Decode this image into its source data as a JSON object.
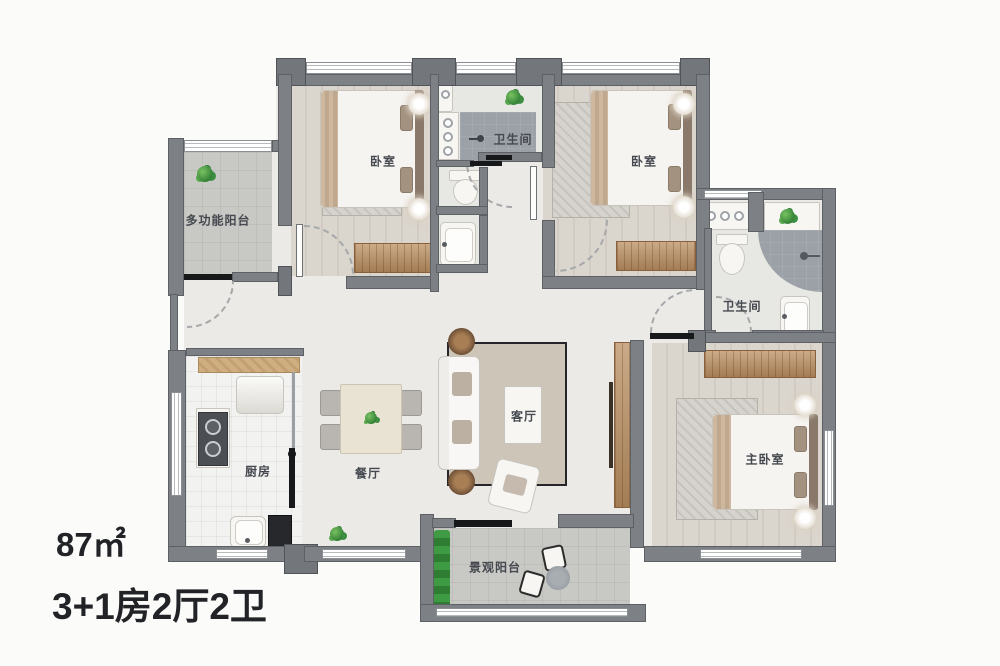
{
  "annotation": {
    "area": "87㎡",
    "layout": "3+1房2厅2卫"
  },
  "rooms": {
    "multi_balcony": {
      "label": "多功能阳台"
    },
    "bedroom1": {
      "label": "卧室"
    },
    "bath_top": {
      "label": "卫生间"
    },
    "bedroom2": {
      "label": "卧室"
    },
    "bath_right": {
      "label": "卫生间"
    },
    "kitchen": {
      "label": "厨房"
    },
    "dining": {
      "label": "餐厅"
    },
    "living": {
      "label": "客厅"
    },
    "master_bedroom": {
      "label": "主卧室"
    },
    "view_balcony": {
      "label": "景观阳台"
    }
  },
  "colors": {
    "wall": "#7d8186",
    "wood": "#b98e60",
    "shower": "#9ba1a7",
    "plant": "#2e7d33",
    "rug": "#cdc5b8"
  }
}
